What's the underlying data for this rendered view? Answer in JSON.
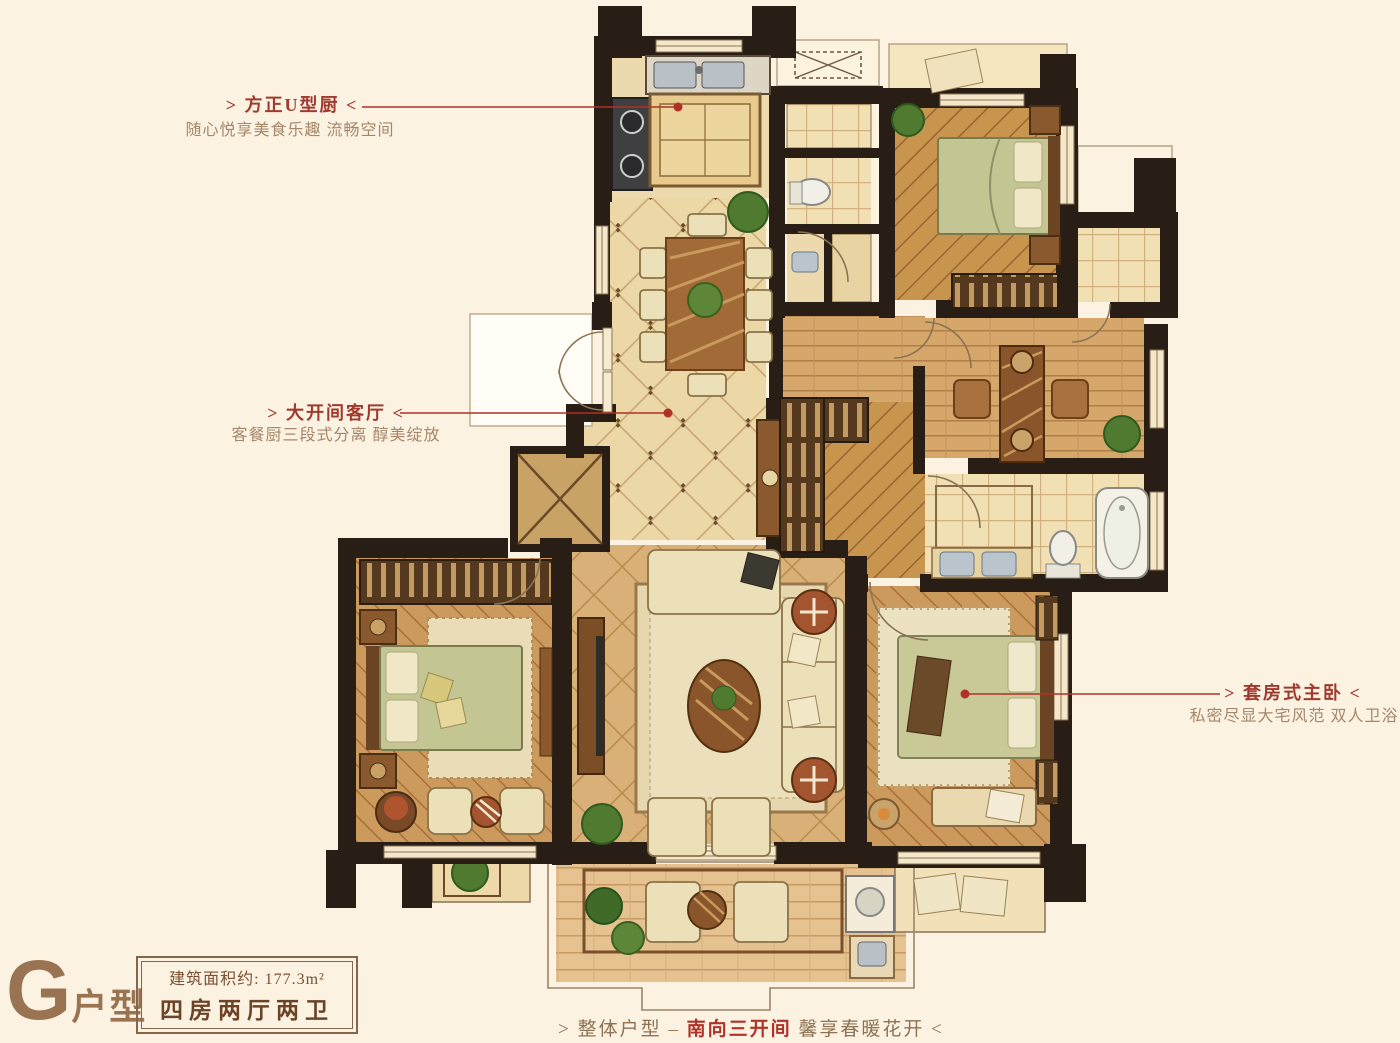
{
  "page": {
    "background": "#fcf2e2"
  },
  "colors": {
    "annotation_red": "#b13127",
    "title_red": "#a03a2e",
    "subtitle_brown": "#a5876a",
    "label_brown": "#9a7452",
    "wall_dark": "#281e15"
  },
  "annotations": {
    "kitchen": {
      "title": "> 方正U型厨 <",
      "subtitle": "随心悦享美食乐趣 流畅空间"
    },
    "living": {
      "title": "> 大开间客厅 <",
      "subtitle": "客餐厨三段式分离 醇美绽放"
    },
    "master": {
      "title": "> 套房式主卧 <",
      "subtitle": "私密尽显大宅风范 双人卫浴"
    },
    "bottom": {
      "prefix": "> 整体户型 – ",
      "highlight": "南向三开间",
      "suffix": " 馨享春暖花开 <"
    }
  },
  "unit_label": {
    "letter": "G",
    "suffix": "户型"
  },
  "info_box": {
    "area_line": "建筑面积约: 177.3m²",
    "layout_line": "四房两厅两卫"
  }
}
